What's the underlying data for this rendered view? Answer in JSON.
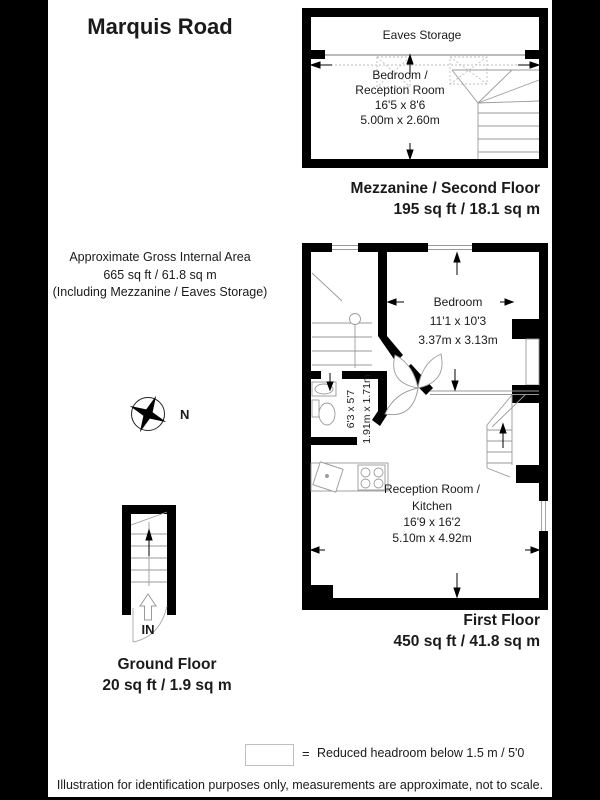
{
  "title": "Marquis Road",
  "gross_area": {
    "line1": "Approximate Gross Internal Area",
    "line2": "665 sq ft / 61.8 sq m",
    "line3": "(Including Mezzanine / Eaves Storage)"
  },
  "compass": {
    "label": "N"
  },
  "mezzanine": {
    "eaves_label": "Eaves Storage",
    "room": {
      "name1": "Bedroom /",
      "name2": "Reception Room",
      "imperial": "16'5 x 8'6",
      "metric": "5.00m x 2.60m"
    },
    "floor_label": "Mezzanine / Second Floor",
    "floor_area": "195 sq ft / 18.1 sq m"
  },
  "first_floor": {
    "bedroom": {
      "name": "Bedroom",
      "imperial": "11'1 x 10'3",
      "metric": "3.37m x 3.13m"
    },
    "bathroom": {
      "imperial": "6'3 x 5'7",
      "metric": "1.91m x 1.71m"
    },
    "reception": {
      "name1": "Reception Room /",
      "name2": "Kitchen",
      "imperial": "16'9 x 16'2",
      "metric": "5.10m x 4.92m"
    },
    "floor_label": "First Floor",
    "floor_area": "450 sq ft / 41.8 sq m"
  },
  "ground_floor": {
    "in_label": "IN",
    "floor_label": "Ground Floor",
    "floor_area": "20 sq ft / 1.9 sq m"
  },
  "legend": {
    "symbol": "=",
    "label": "Reduced headroom below 1.5 m / 5'0"
  },
  "disclaimer": "Illustration for identification purposes only, measurements are approximate, not to scale.",
  "colors": {
    "wall": "#000000",
    "background": "#ffffff",
    "thin_line": "#999999",
    "letterbox": "#000000"
  }
}
